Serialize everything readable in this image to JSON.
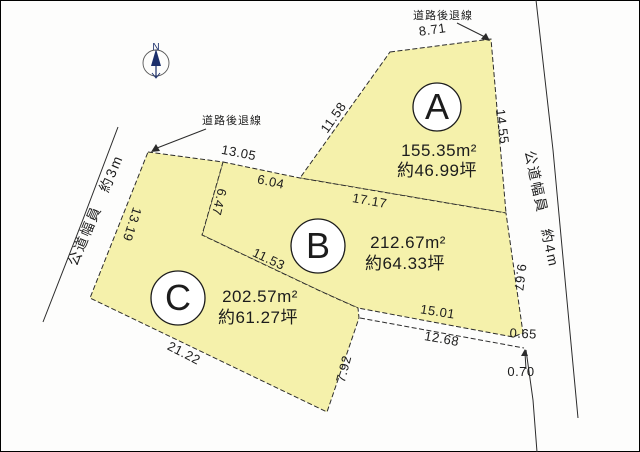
{
  "diagram": {
    "compass": {
      "label": "N"
    },
    "plots": [
      {
        "label": "A",
        "area_m2": "155.35m²",
        "area_tsubo": "約46.99坪"
      },
      {
        "label": "B",
        "area_m2": "212.67m²",
        "area_tsubo": "約64.33坪"
      },
      {
        "label": "C",
        "area_m2": "202.57m²",
        "area_tsubo": "約61.27坪"
      }
    ],
    "roads": {
      "left": {
        "label": "公道幅員　約3m"
      },
      "right": {
        "label": "公道幅員　約4m"
      }
    },
    "setback": {
      "top": "道路後退線",
      "left": "道路後退線"
    },
    "dimensions": {
      "a_top": "8.71",
      "a_right": "14.55",
      "a_left": "11.58",
      "b_top_left": "13.05",
      "b_top_mid": "6.04",
      "b_left": "6.47",
      "ab_boundary": "17.17",
      "c_left": "13.19",
      "b_right": "9.67",
      "bc_boundary": "11.53",
      "c_bottom": "21.22",
      "c_right": "7.92",
      "b_bottom": "15.01",
      "setback_bottom": "12.68",
      "corner_gap": "0.65",
      "setback_offset": "0.70"
    },
    "colors": {
      "plot_fill": "#f5f1ab",
      "line": "#2b2b2b",
      "compass_arrow": "#1b2f6b"
    }
  }
}
